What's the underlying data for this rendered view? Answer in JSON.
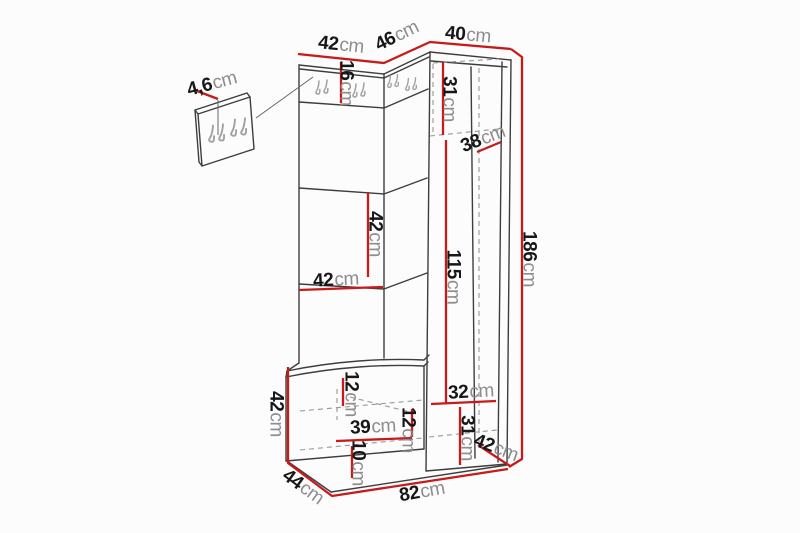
{
  "figure": {
    "kind": "furniture dimension diagram",
    "subject": "hallway unit with coat hooks, corner wardrobe and shoe bench",
    "colors": {
      "background": "#fcfcfc",
      "dimension_line": "#c81a1a",
      "drawing_line": "#3d3d3d",
      "value_text": "#171717",
      "unit_text": "#8d8d8d"
    }
  },
  "dims": {
    "top_width_left": {
      "value": "42",
      "unit": "cm"
    },
    "top_width_middle": {
      "value": "46",
      "unit": "cm"
    },
    "top_width_right": {
      "value": "40",
      "unit": "cm"
    },
    "hook_panel_thickness": {
      "value": "4,6",
      "unit": "cm"
    },
    "hook_strip_height": {
      "value": "16",
      "unit": "cm"
    },
    "upper_section_height": {
      "value": "31",
      "unit": "cm"
    },
    "upper_shelf_width": {
      "value": "38",
      "unit": "cm"
    },
    "mirror_section_height": {
      "value": "42",
      "unit": "cm"
    },
    "panel_width": {
      "value": "42",
      "unit": "cm"
    },
    "interior_height": {
      "value": "115",
      "unit": "cm"
    },
    "total_height": {
      "value": "186",
      "unit": "cm"
    },
    "bench_height": {
      "value": "42",
      "unit": "cm"
    },
    "bench_top_section": {
      "value": "12",
      "unit": "cm"
    },
    "bench_interior_width": {
      "value": "39",
      "unit": "cm"
    },
    "bench_bottom_section": {
      "value": "10",
      "unit": "cm"
    },
    "lower_shelf_width": {
      "value": "32",
      "unit": "cm"
    },
    "lower_mid_section": {
      "value": "12",
      "unit": "cm"
    },
    "lower_section_height": {
      "value": "31",
      "unit": "cm"
    },
    "cabinet_depth": {
      "value": "42",
      "unit": "cm"
    },
    "total_width": {
      "value": "82",
      "unit": "cm"
    },
    "bench_depth": {
      "value": "44",
      "unit": "cm"
    }
  }
}
